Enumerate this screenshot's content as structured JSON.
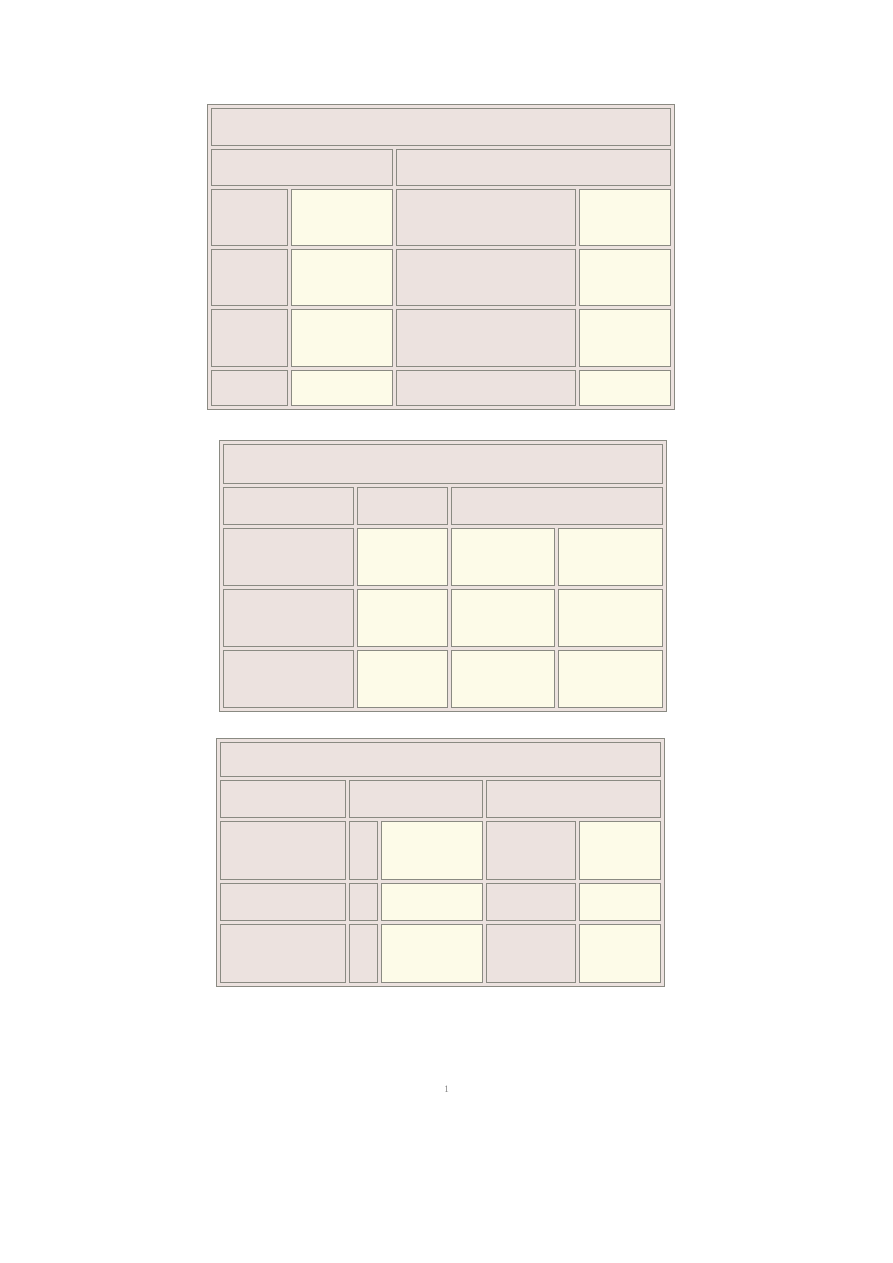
{
  "page": {
    "background": "#ffffff",
    "footer": {
      "page_number": "1"
    }
  },
  "styles": {
    "border_color": "#8a8a82",
    "fill_pink": "#ece2df",
    "fill_cream": "#fdfbe8",
    "table_background": "#ece2df",
    "page_number_color": "#7f7f7f"
  },
  "tables": [
    {
      "id": "form-table-1",
      "position": {
        "left": 207,
        "top": 104
      },
      "col_widths": [
        77,
        102,
        180,
        92
      ],
      "rows": [
        {
          "height": 36,
          "cells": [
            {
              "colspan": 4,
              "fill": "pink",
              "text": ""
            }
          ]
        },
        {
          "height": 35,
          "cells": [
            {
              "colspan": 2,
              "fill": "pink",
              "text": ""
            },
            {
              "colspan": 2,
              "fill": "pink",
              "text": ""
            }
          ]
        },
        {
          "height": 55,
          "cells": [
            {
              "fill": "pink",
              "text": ""
            },
            {
              "fill": "cream",
              "text": ""
            },
            {
              "fill": "pink",
              "text": ""
            },
            {
              "fill": "cream",
              "text": ""
            }
          ]
        },
        {
          "height": 55,
          "cells": [
            {
              "fill": "pink",
              "text": ""
            },
            {
              "fill": "cream",
              "text": ""
            },
            {
              "fill": "pink",
              "text": ""
            },
            {
              "fill": "cream",
              "text": ""
            }
          ]
        },
        {
          "height": 56,
          "cells": [
            {
              "fill": "pink",
              "text": ""
            },
            {
              "fill": "cream",
              "text": ""
            },
            {
              "fill": "pink",
              "text": ""
            },
            {
              "fill": "cream",
              "text": ""
            }
          ]
        },
        {
          "height": 34,
          "cells": [
            {
              "fill": "pink",
              "text": ""
            },
            {
              "fill": "cream",
              "text": ""
            },
            {
              "fill": "pink",
              "text": ""
            },
            {
              "fill": "cream",
              "text": ""
            }
          ]
        }
      ]
    },
    {
      "id": "form-table-2",
      "position": {
        "left": 219,
        "top": 440
      },
      "col_widths": [
        131,
        91,
        104,
        105
      ],
      "rows": [
        {
          "height": 38,
          "cells": [
            {
              "colspan": 4,
              "fill": "pink",
              "text": ""
            }
          ]
        },
        {
          "height": 36,
          "cells": [
            {
              "fill": "pink",
              "text": ""
            },
            {
              "fill": "pink",
              "text": ""
            },
            {
              "colspan": 2,
              "fill": "pink",
              "text": ""
            }
          ]
        },
        {
          "height": 56,
          "cells": [
            {
              "fill": "pink",
              "text": ""
            },
            {
              "fill": "cream",
              "text": ""
            },
            {
              "fill": "cream",
              "text": ""
            },
            {
              "fill": "cream",
              "text": ""
            }
          ]
        },
        {
          "height": 56,
          "cells": [
            {
              "fill": "pink",
              "text": ""
            },
            {
              "fill": "cream",
              "text": ""
            },
            {
              "fill": "cream",
              "text": ""
            },
            {
              "fill": "cream",
              "text": ""
            }
          ]
        },
        {
          "height": 56,
          "cells": [
            {
              "fill": "pink",
              "text": ""
            },
            {
              "fill": "cream",
              "text": ""
            },
            {
              "fill": "cream",
              "text": ""
            },
            {
              "fill": "cream",
              "text": ""
            }
          ]
        }
      ]
    },
    {
      "id": "form-table-3",
      "position": {
        "left": 216,
        "top": 738
      },
      "col_widths": [
        126,
        29,
        102,
        90,
        82
      ],
      "rows": [
        {
          "height": 33,
          "cells": [
            {
              "colspan": 5,
              "fill": "pink",
              "text": ""
            }
          ]
        },
        {
          "height": 36,
          "cells": [
            {
              "fill": "pink",
              "text": ""
            },
            {
              "colspan": 2,
              "fill": "pink",
              "text": ""
            },
            {
              "colspan": 2,
              "fill": "pink",
              "text": ""
            }
          ]
        },
        {
          "height": 57,
          "cells": [
            {
              "fill": "pink",
              "text": ""
            },
            {
              "fill": "pink",
              "text": ""
            },
            {
              "fill": "cream",
              "text": ""
            },
            {
              "fill": "pink",
              "text": ""
            },
            {
              "fill": "cream",
              "text": ""
            }
          ]
        },
        {
          "height": 36,
          "cells": [
            {
              "fill": "pink",
              "text": ""
            },
            {
              "fill": "pink",
              "text": ""
            },
            {
              "fill": "cream",
              "text": ""
            },
            {
              "fill": "pink",
              "text": ""
            },
            {
              "fill": "cream",
              "text": ""
            }
          ]
        },
        {
          "height": 57,
          "cells": [
            {
              "fill": "pink",
              "text": ""
            },
            {
              "fill": "pink",
              "text": ""
            },
            {
              "fill": "cream",
              "text": ""
            },
            {
              "fill": "pink",
              "text": ""
            },
            {
              "fill": "cream",
              "text": ""
            }
          ]
        }
      ]
    }
  ]
}
